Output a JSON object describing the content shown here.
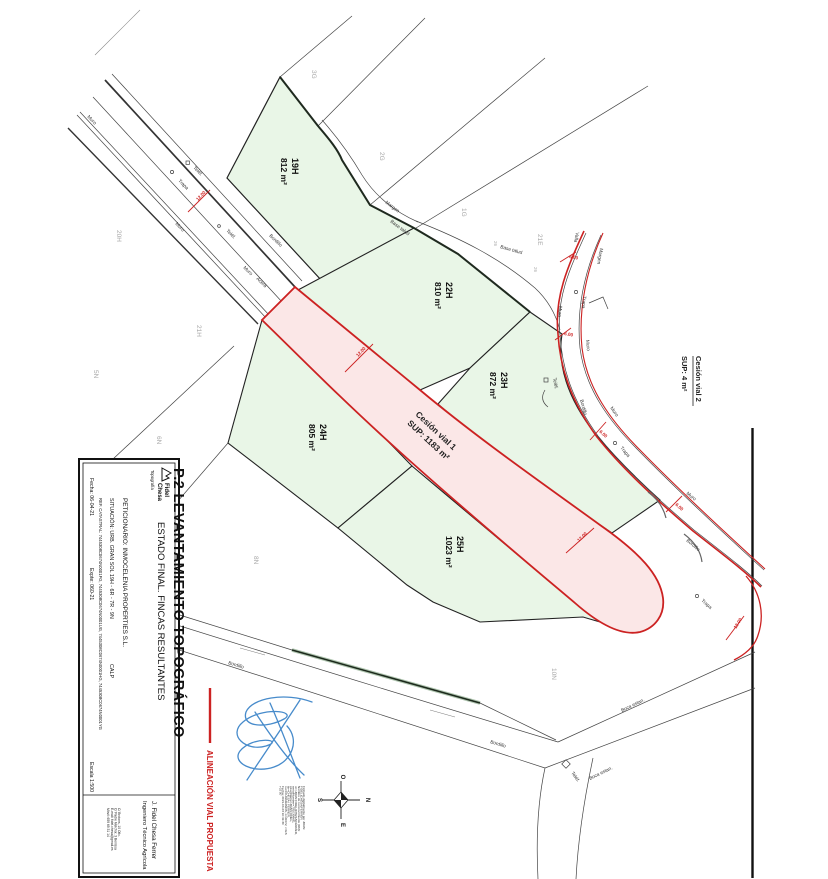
{
  "page": {
    "background": "#ffffff"
  },
  "colors": {
    "parcel_green": "#e9f6e7",
    "cession_pink": "#fbe7e7",
    "alignment_red": "#cc2222",
    "signature_blue": "#3d85c8",
    "neighbor_gray": "#a8a8a8"
  },
  "title_block": {
    "logo": {
      "name_line1": "Fidel",
      "name_line2": "Chesa",
      "subtitle": "Topografía"
    },
    "sheet_title": "P.2 LEVANTAMIENTO TOPOGRÁFICO",
    "sheet_subtitle": "ESTADO FINAL. FINCAS RESULTANTES",
    "petitioner": "PETICIONARIO:  INMOCELENIA PROPERTIES S.L.",
    "situation": "SITUACIÓN:  URB. GRAN SOL 19H - 6R - 7R - 9N",
    "situation_city": "CALP",
    "cadastral": "REF. CATASTRAL:  7445308C0674N0001FG, 7445308C0674N0001UG, 7445308C0674N0001HG, 7445308C0674N0001YG",
    "date": "Fecha: 06-04-21",
    "file_no": "Expte:  060-21",
    "scale": "Escala  1:500",
    "engineer_name": "J. Fidel Chesa Ferrer",
    "engineer_title": "Ingeniero Técnico Agrícola",
    "contact_lines": [
      "C/ Brotons, 10 Ofic.",
      "C/ Padre Melchor, 3 Benissa",
      "E-mail: fidel.chesa@gmail.es",
      "Móvil: 659 69 31 14"
    ]
  },
  "legend": {
    "alignment_label": "ALINEACIÓN VIAL PROPUESTA"
  },
  "parcels": [
    {
      "id": "19H",
      "area": "812 m²"
    },
    {
      "id": "22H",
      "area": "810 m²"
    },
    {
      "id": "23H",
      "area": "872 m²"
    },
    {
      "id": "24H",
      "area": "805 m²"
    },
    {
      "id": "25H",
      "area": "1023 m²"
    }
  ],
  "cessions": [
    {
      "name": "Cesión vial 1",
      "sup": "SUP: 1183 m²"
    },
    {
      "name": "Cesión vial 2",
      "sup": "SUP: 4 m²"
    }
  ],
  "neighbors": [
    {
      "t": "3G"
    },
    {
      "t": "2G"
    },
    {
      "t": "1G"
    },
    {
      "t": "21E"
    },
    {
      "t": "20H"
    },
    {
      "t": "21H"
    },
    {
      "t": "5N"
    },
    {
      "t": "6N"
    },
    {
      "t": "8N"
    },
    {
      "t": "10N"
    },
    {
      "t": "26"
    },
    {
      "t": "26"
    }
  ],
  "furniture": [
    {
      "t": "Muro"
    },
    {
      "t": "Teléf."
    },
    {
      "t": "Trapa"
    },
    {
      "t": "Muro"
    },
    {
      "t": "Teléf."
    },
    {
      "t": "Bordillo"
    },
    {
      "t": "Muro"
    },
    {
      "t": "Acera"
    },
    {
      "t": "Margen"
    },
    {
      "t": "Base talud"
    },
    {
      "t": "Base talud"
    },
    {
      "t": "Valla"
    },
    {
      "t": "Margen"
    },
    {
      "t": "Muro"
    },
    {
      "t": "Trapa"
    },
    {
      "t": "Muro"
    },
    {
      "t": "Teléf."
    },
    {
      "t": "Bordillo"
    },
    {
      "t": "Muro"
    },
    {
      "t": "Trapa"
    },
    {
      "t": "Muro"
    },
    {
      "t": "Bordillo"
    },
    {
      "t": "Trapa"
    },
    {
      "t": "Bordillo"
    },
    {
      "t": "Bordillo"
    },
    {
      "t": "Teléf."
    },
    {
      "t": "Boca estan."
    },
    {
      "t": "Boca estan."
    }
  ],
  "dims": [
    {
      "v": "12.00"
    },
    {
      "v": "12.00"
    },
    {
      "v": "6.00"
    },
    {
      "v": "6.00"
    },
    {
      "v": "6.00"
    },
    {
      "v": "6.00"
    },
    {
      "v": "12.00"
    },
    {
      "v": "12.00"
    }
  ],
  "compass": {
    "o": "O",
    "n": "N",
    "e": "E",
    "s": "S"
  },
  "stamp": {
    "lines": [
      "Firmado digitalmente por JOAN",
      "FIDEL|CHESA|FERRER",
      "Nombre de reconocimiento (DN):",
      "cn=JOAN FIDEL|CHESA|FERRER,",
      "serialNumber=79103996G,",
      "givenName=JOAN FIDEL,",
      "sn=CHESA I FERRER,",
      "ou=CIUDADANOS, o=ACCV, c=ES",
      "Fecha: 2021.04.23 10:41:30",
      "+02'00'"
    ]
  }
}
